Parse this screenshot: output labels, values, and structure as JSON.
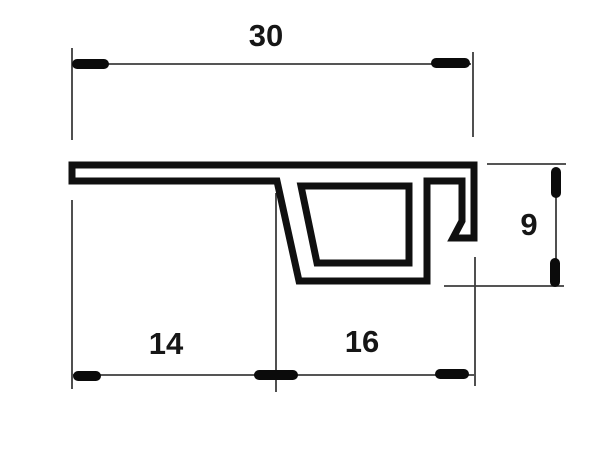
{
  "drawing": {
    "background_color": "#ffffff",
    "outline_color": "#101010",
    "dimension_line_color": "#3d3d3d",
    "tick_color": "#0b0b0b",
    "label_color": "#161616",
    "dimensions": {
      "total_width": {
        "label": "30"
      },
      "left_width": {
        "label": "14"
      },
      "right_width": {
        "label": "16"
      },
      "right_height": {
        "label": "9"
      }
    }
  }
}
